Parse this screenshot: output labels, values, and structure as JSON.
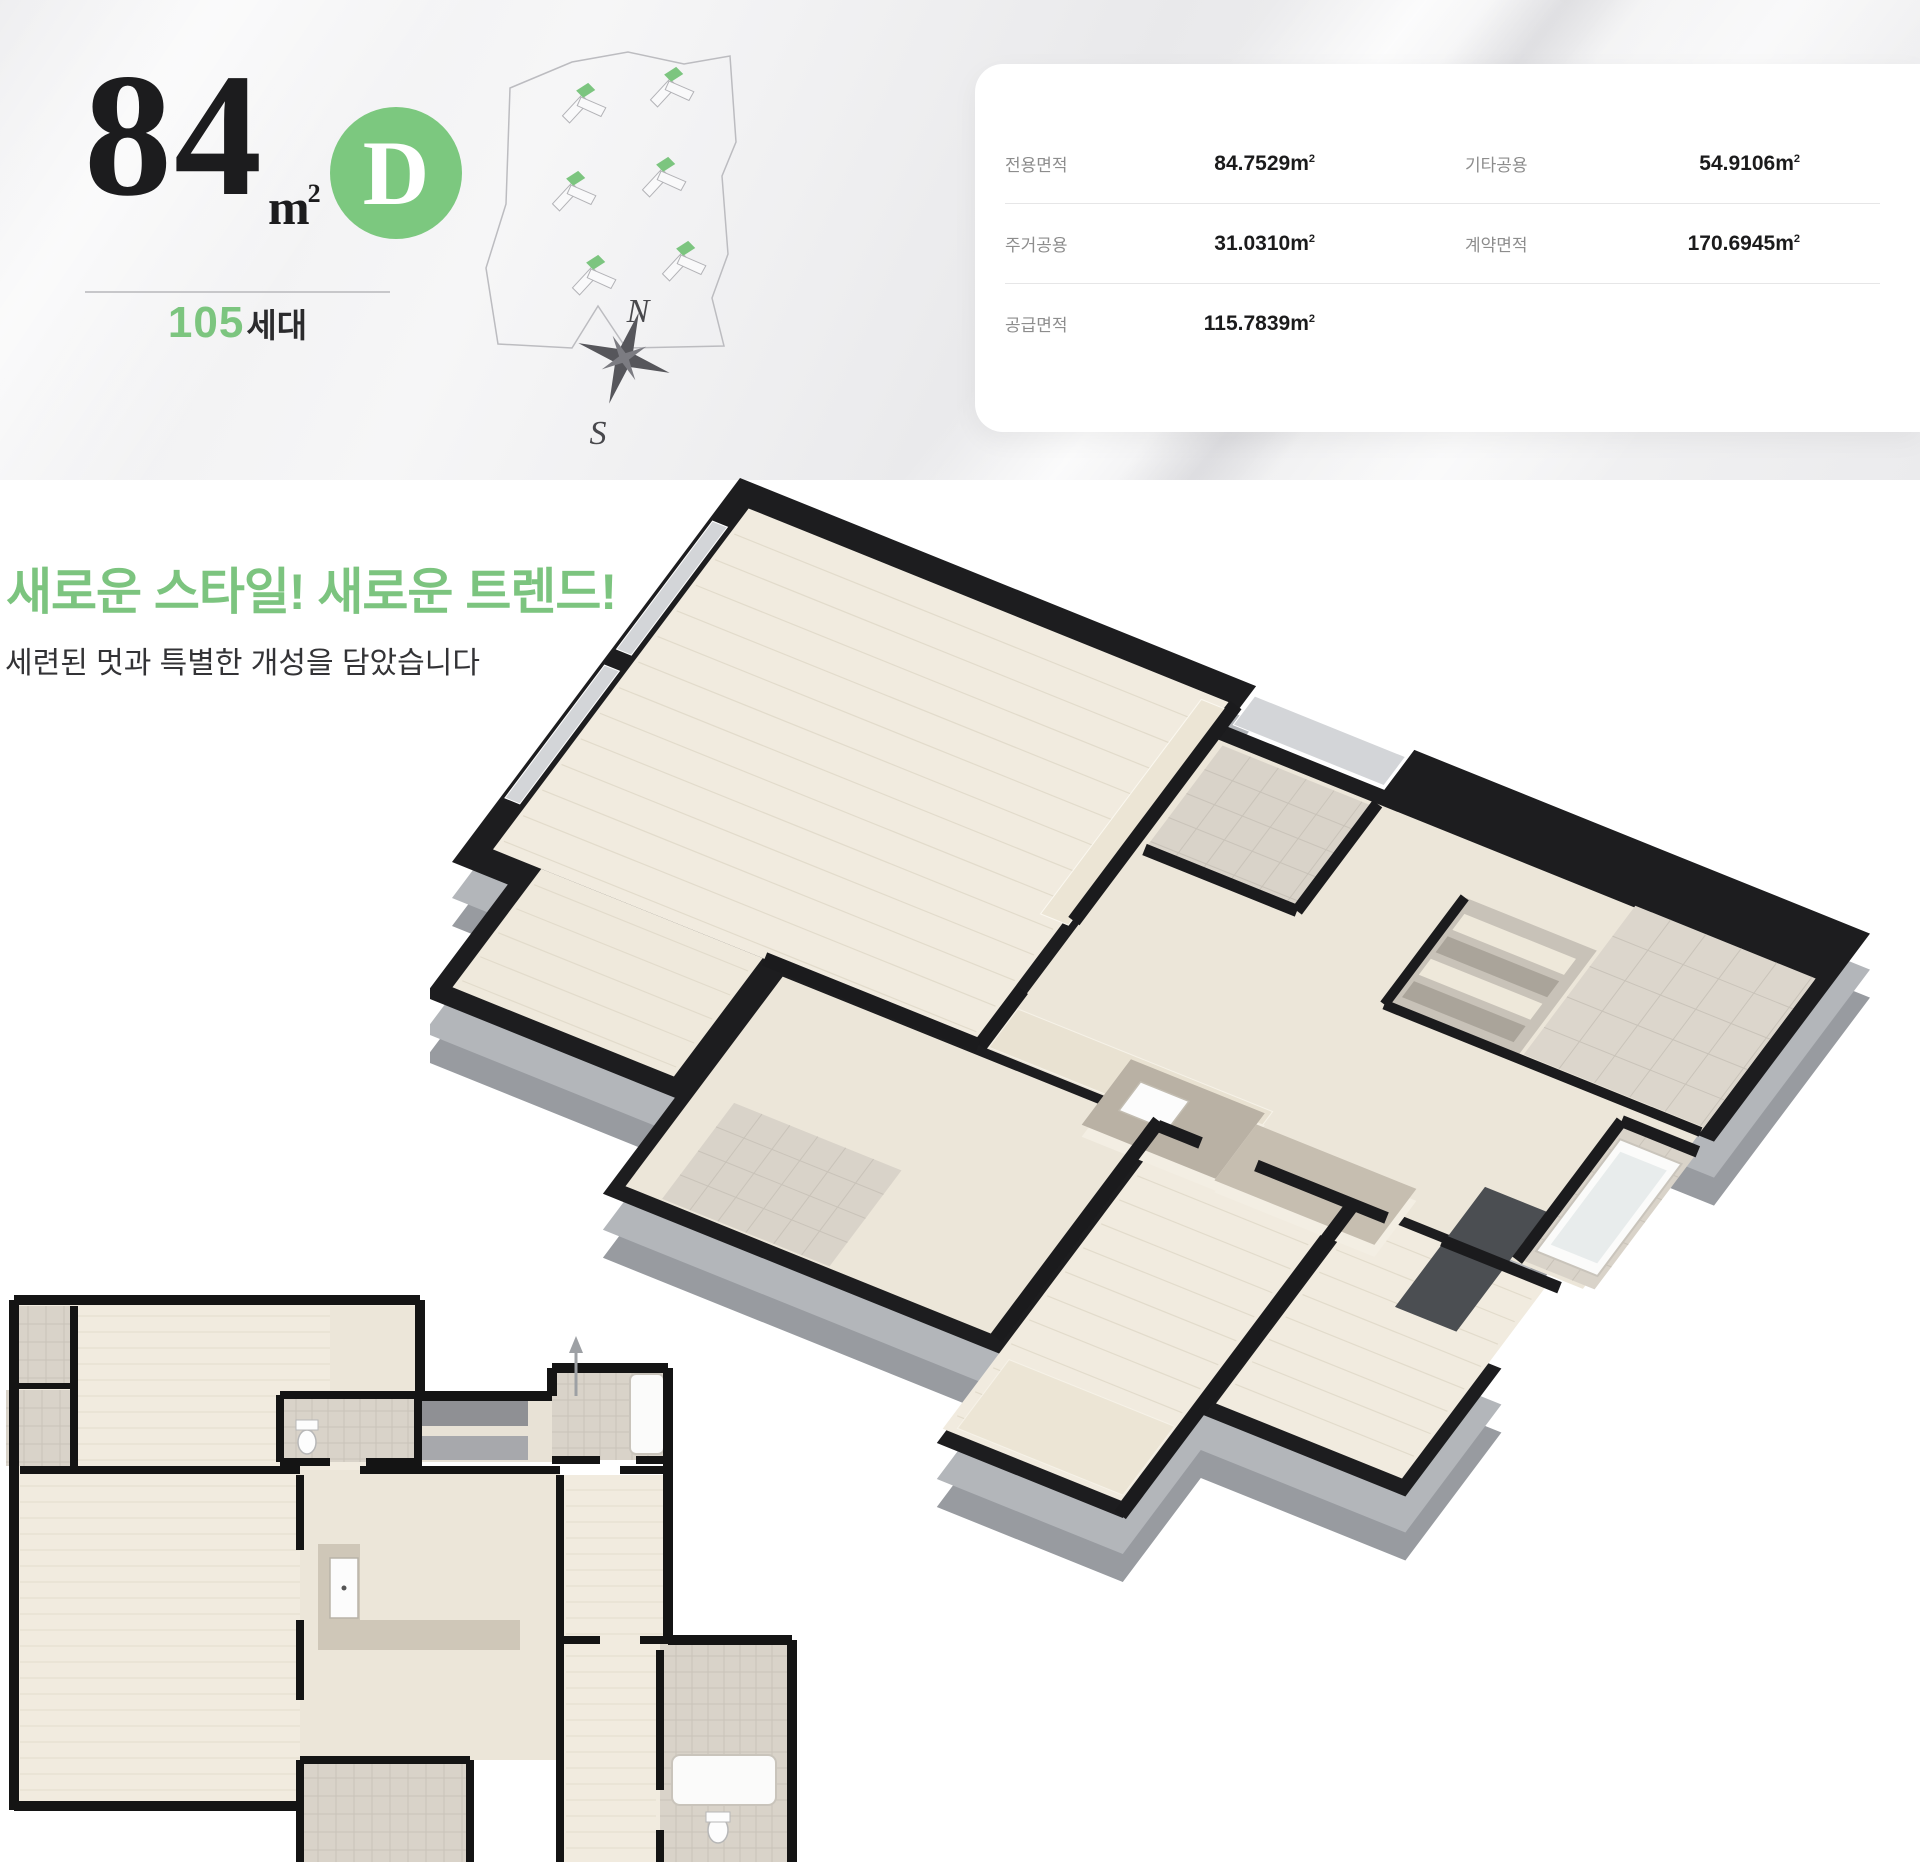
{
  "unit_header": {
    "area_number": "84",
    "area_unit_m": "m",
    "area_unit_sup": "2",
    "type_letter": "D",
    "household_number": "105",
    "household_suffix": "세대"
  },
  "site_plan": {
    "compass_north": "N",
    "compass_south": "S"
  },
  "area_table": {
    "unit_m": "m",
    "unit_sup": "2",
    "rows": [
      {
        "l_label": "전용면적",
        "l_value": "84.7529",
        "r_label": "기타공용",
        "r_value": "54.9106"
      },
      {
        "l_label": "주거공용",
        "l_value": "31.0310",
        "r_label": "계약면적",
        "r_value": "170.6945"
      },
      {
        "l_label": "공급면적",
        "l_value": "115.7839"
      }
    ]
  },
  "intro": {
    "headline": "새로운 스타일! 새로운 트렌드!",
    "subtitle": "세련된 멋과 특별한 개성을 담았습니다"
  },
  "colors": {
    "accent_green": "#7cc57f",
    "badge_green": "#7cc87f",
    "wall_dark": "#1d1d1f",
    "wall_side": "#989ba0",
    "wall_side_light": "#b3b6ba",
    "floor_cream": "#f1ebdf",
    "floor_cream2": "#ece6d9",
    "tile": "#d9d3c9",
    "label_gray": "#8d8d8d",
    "value_dark": "#1b1b1c"
  }
}
